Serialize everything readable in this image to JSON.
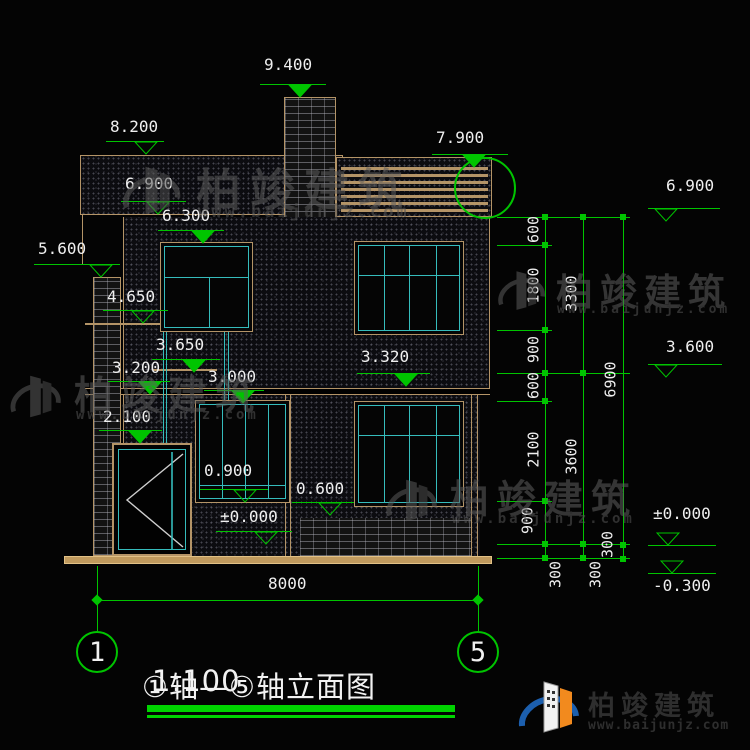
{
  "title_block": {
    "title": "①轴—⑤轴立面图",
    "scale": "1:100"
  },
  "axes": {
    "left": "1",
    "right": "5",
    "dim_total": "8000"
  },
  "watermark": {
    "cn": "柏竣建筑",
    "url": "www.baijunjz.com"
  },
  "logo": {
    "cn": "柏竣建筑",
    "url": "www.baijunjz.com"
  },
  "colors": {
    "dim_green": "#00c400",
    "frame_tan": "#b49467",
    "window_cyan": "#35bcbc",
    "bar_green": "#00d400",
    "beam_tan": "#c09a5e"
  },
  "levels": [
    {
      "label": "9.400",
      "tx": 264,
      "ty": 57,
      "lx1": 260,
      "lx2": 326,
      "ly": 84,
      "mx": 300,
      "style": "solid"
    },
    {
      "label": "8.200",
      "tx": 110,
      "ty": 119,
      "lx1": 106,
      "lx2": 164,
      "ly": 141,
      "mx": 146,
      "style": "hollow"
    },
    {
      "label": "6.900",
      "tx": 125,
      "ty": 176,
      "lx1": 121,
      "lx2": 186,
      "ly": 201,
      "mx": 158,
      "style": "hollow"
    },
    {
      "label": "6.300",
      "tx": 162,
      "ty": 208,
      "lx1": 158,
      "lx2": 224,
      "ly": 230,
      "mx": 203,
      "style": "solid"
    },
    {
      "label": "7.900",
      "tx": 436,
      "ty": 130,
      "lx1": 432,
      "lx2": 508,
      "ly": 154,
      "mx": 474,
      "style": "solid"
    },
    {
      "label": "5.600",
      "tx": 38,
      "ty": 241,
      "lx1": 34,
      "lx2": 120,
      "ly": 264,
      "mx": 101,
      "style": "hollow"
    },
    {
      "label": "4.650",
      "tx": 107,
      "ty": 289,
      "lx1": 103,
      "lx2": 168,
      "ly": 310,
      "mx": 143,
      "style": "hollow"
    },
    {
      "label": "3.650",
      "tx": 156,
      "ty": 337,
      "lx1": 152,
      "lx2": 220,
      "ly": 359,
      "mx": 194,
      "style": "solid"
    },
    {
      "label": "3.200",
      "tx": 112,
      "ty": 360,
      "lx1": 108,
      "lx2": 170,
      "ly": 381,
      "mx": 150,
      "style": "solid"
    },
    {
      "label": "3.000",
      "tx": 208,
      "ty": 369,
      "lx1": 204,
      "lx2": 264,
      "ly": 390,
      "mx": 243,
      "style": "solid"
    },
    {
      "label": "3.320",
      "tx": 361,
      "ty": 349,
      "lx1": 357,
      "lx2": 430,
      "ly": 373,
      "mx": 406,
      "style": "solid"
    },
    {
      "label": "2.100",
      "tx": 103,
      "ty": 409,
      "lx1": 99,
      "lx2": 162,
      "ly": 430,
      "mx": 140,
      "style": "solid"
    },
    {
      "label": "0.900",
      "tx": 204,
      "ty": 463,
      "lx1": 200,
      "lx2": 268,
      "ly": 489,
      "mx": 245,
      "style": "hollow"
    },
    {
      "label": "0.600",
      "tx": 296,
      "ty": 481,
      "lx1": 292,
      "lx2": 354,
      "ly": 502,
      "mx": 330,
      "style": "hollow"
    },
    {
      "label": "±0.000",
      "tx": 220,
      "ty": 509,
      "lx1": 216,
      "lx2": 292,
      "ly": 531,
      "mx": 266,
      "style": "hollow"
    },
    {
      "label": "6.900",
      "tx": 666,
      "ty": 178,
      "lx1": 648,
      "lx2": 720,
      "ly": 208,
      "mx": 666,
      "style": "hollow"
    },
    {
      "label": "3.600",
      "tx": 666,
      "ty": 339,
      "lx1": 648,
      "lx2": 722,
      "ly": 364,
      "mx": 666,
      "style": "hollow"
    },
    {
      "label": "±0.000",
      "tx": 653,
      "ty": 506,
      "lx1": 648,
      "lx2": 716,
      "ly": 545,
      "mx": 668,
      "style": "hollow",
      "above": true
    },
    {
      "label": "-0.300",
      "tx": 653,
      "ty": 578,
      "lx1": 648,
      "lx2": 716,
      "ly": 573,
      "mx": 672,
      "style": "hollow",
      "above": true
    }
  ],
  "chains": [
    {
      "x": 545,
      "ticks": [
        217,
        245,
        330,
        373,
        401,
        501,
        544,
        558
      ],
      "labels": [
        {
          "t": "600",
          "x": 534,
          "y": 231
        },
        {
          "t": "1800",
          "x": 534,
          "y": 287
        },
        {
          "t": "900",
          "x": 534,
          "y": 351
        },
        {
          "t": "600",
          "x": 534,
          "y": 387
        },
        {
          "t": "2100",
          "x": 534,
          "y": 451
        },
        {
          "t": "900",
          "x": 528,
          "y": 522
        },
        {
          "t": "300",
          "x": 556,
          "y": 576
        }
      ]
    },
    {
      "x": 583,
      "ticks": [
        217,
        373,
        544,
        558
      ],
      "labels": [
        {
          "t": "3300",
          "x": 572,
          "y": 295
        },
        {
          "t": "3600",
          "x": 572,
          "y": 458
        },
        {
          "t": "300",
          "x": 596,
          "y": 576
        }
      ]
    },
    {
      "x": 623,
      "ticks": [
        217,
        545,
        559
      ],
      "labels": [
        {
          "t": "6900",
          "x": 611,
          "y": 381
        },
        {
          "t": "300",
          "x": 608,
          "y": 546
        }
      ]
    }
  ],
  "chain_ext": [
    {
      "y": 217,
      "x1": 497,
      "x2": 630
    },
    {
      "y": 245,
      "x1": 497,
      "x2": 552
    },
    {
      "y": 330,
      "x1": 497,
      "x2": 552
    },
    {
      "y": 373,
      "x1": 497,
      "x2": 630
    },
    {
      "y": 401,
      "x1": 497,
      "x2": 552
    },
    {
      "y": 501,
      "x1": 497,
      "x2": 552
    },
    {
      "y": 544,
      "x1": 497,
      "x2": 630
    },
    {
      "y": 558,
      "x1": 497,
      "x2": 630
    }
  ],
  "bottom_dim": {
    "y": 600,
    "x1": 97,
    "x2": 478,
    "label_x": 268,
    "label_y": 576,
    "ext": [
      {
        "x": 97,
        "y1": 566,
        "y2": 631
      },
      {
        "x": 478,
        "y1": 566,
        "y2": 631
      }
    ],
    "circles": [
      {
        "n": "1",
        "cx": 97,
        "cy": 652
      },
      {
        "n": "5",
        "cx": 478,
        "cy": 652
      }
    ]
  }
}
